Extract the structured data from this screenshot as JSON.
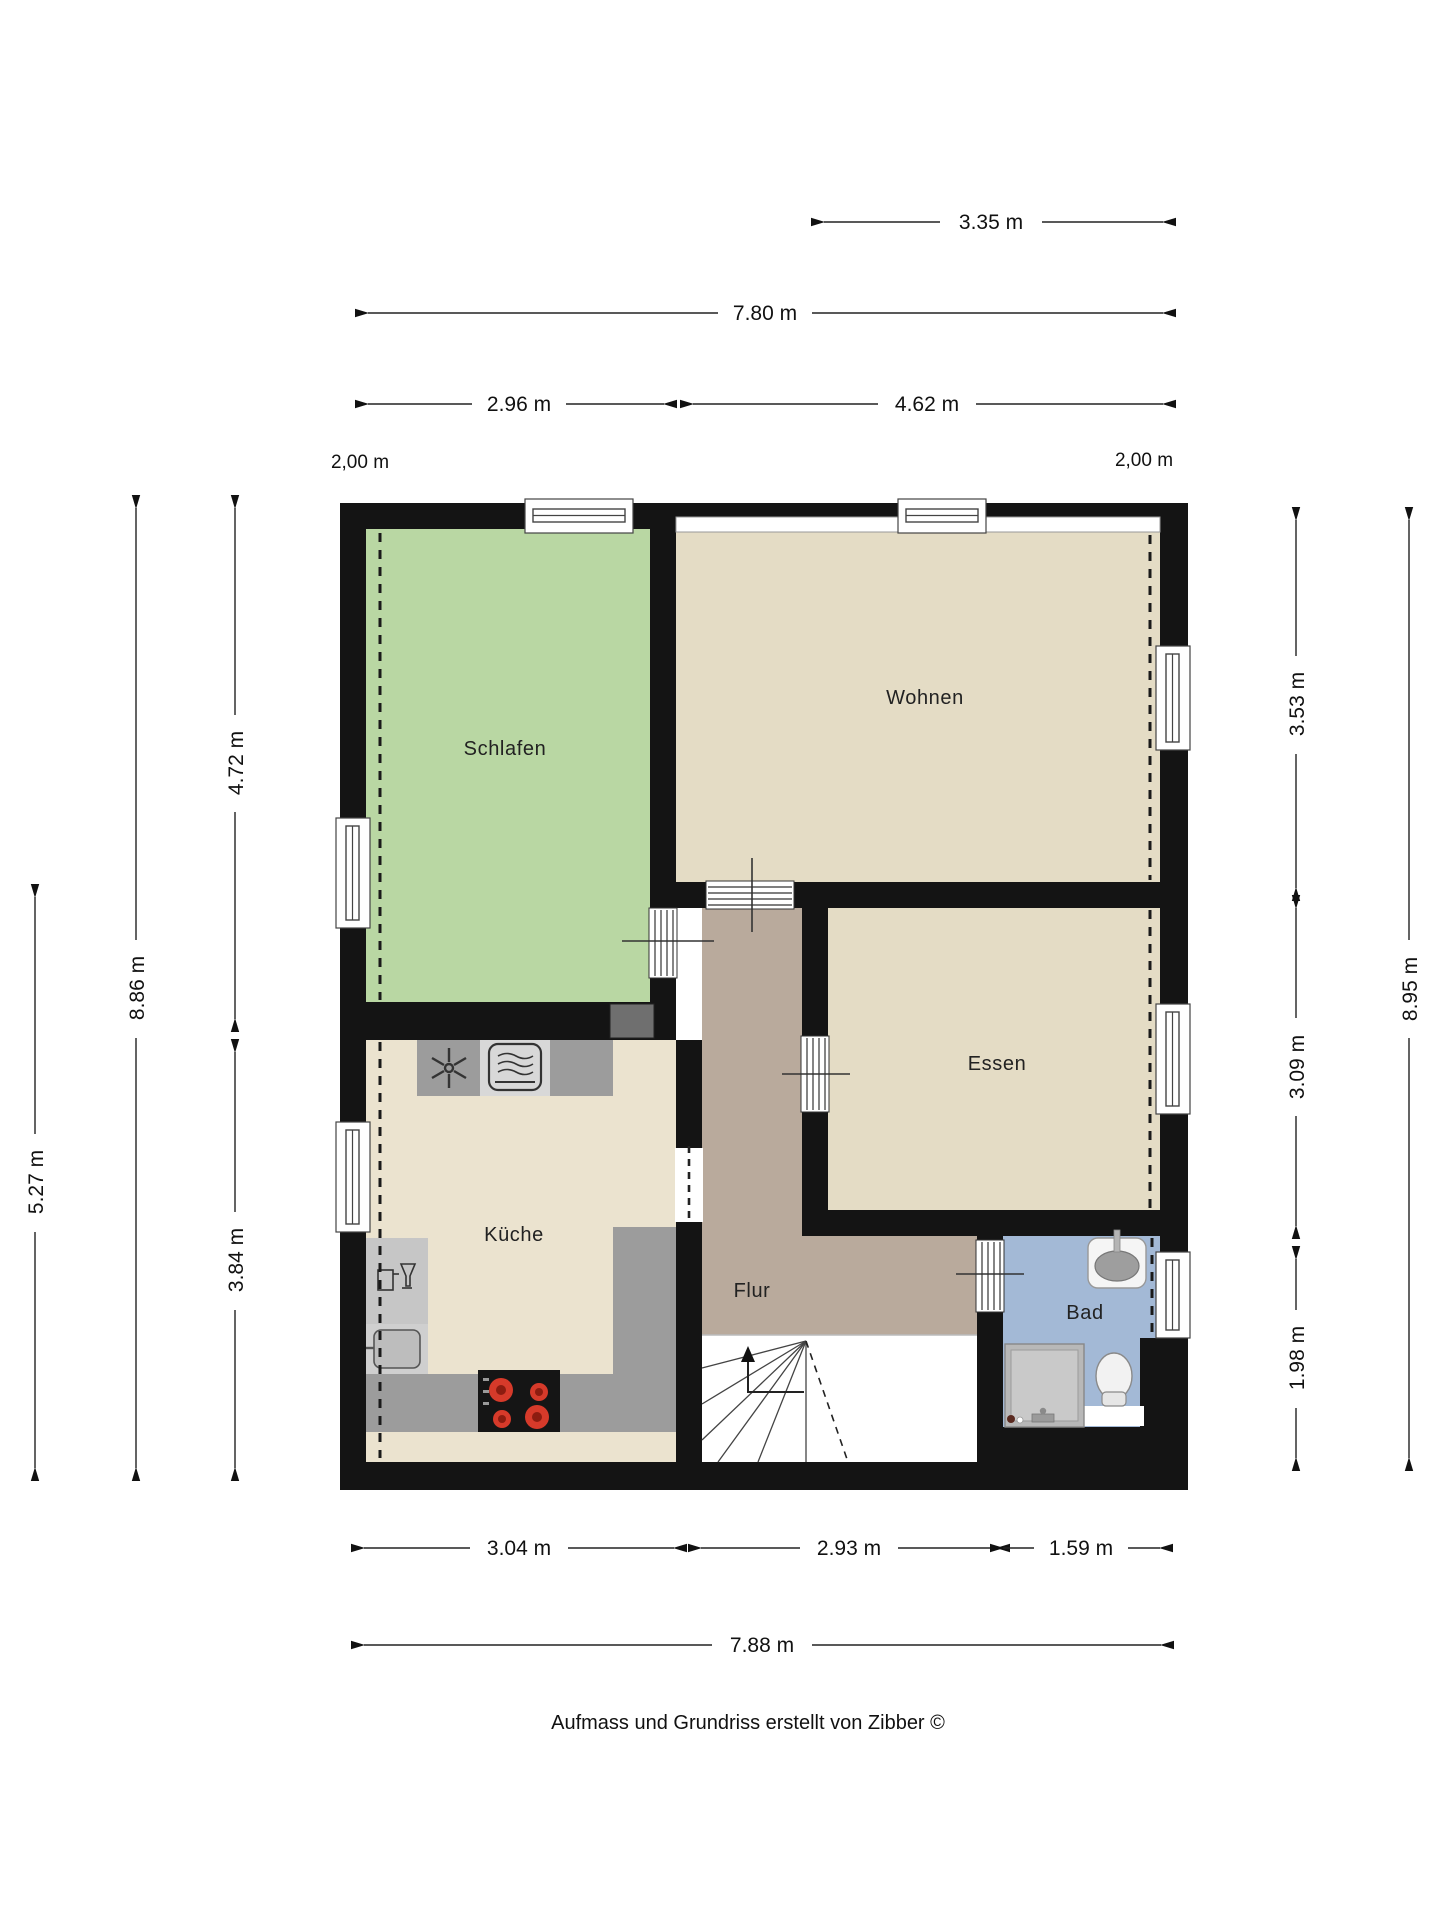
{
  "rooms": {
    "schlafen": {
      "label": "Schlafen"
    },
    "wohnen": {
      "label": "Wohnen"
    },
    "essen": {
      "label": "Essen"
    },
    "kueche": {
      "label": "Küche"
    },
    "flur": {
      "label": "Flur"
    },
    "bad": {
      "label": "Bad"
    }
  },
  "dims": {
    "w_partial_top": "3.35 m",
    "w_total_top": "7.80 m",
    "w_schlafen": "2.96 m",
    "w_wohnen": "4.62 m",
    "note_left": "2,00 m",
    "note_right": "2,00 m",
    "h_schlafen": "4.72 m",
    "h_left_total": "8.86 m",
    "h_left_lower": "5.27 m",
    "h_kueche": "3.84 m",
    "h_wohnen": "3.53 m",
    "h_right_total": "8.95 m",
    "h_essen": "3.09 m",
    "h_bad": "1.98 m",
    "w_kueche": "3.04 m",
    "w_flur": "2.93 m",
    "w_bad": "1.59 m",
    "w_total_bottom": "7.88 m"
  },
  "footer": {
    "credit": "Aufmass und Grundriss erstellt von Zibber ©"
  },
  "colors": {
    "wall": "#141414",
    "schlafen": "#b9d7a3",
    "wohnen": "#e4dcc5",
    "essen": "#e4dcc5",
    "kueche": "#ebe3cf",
    "flur": "#b9aa9c",
    "bad": "#a3b9d6",
    "counter": "#9c9c9c",
    "counter_light": "#d8d8d8",
    "counter_mid": "#c6c6c6",
    "shaft": "#6f6f6f"
  }
}
